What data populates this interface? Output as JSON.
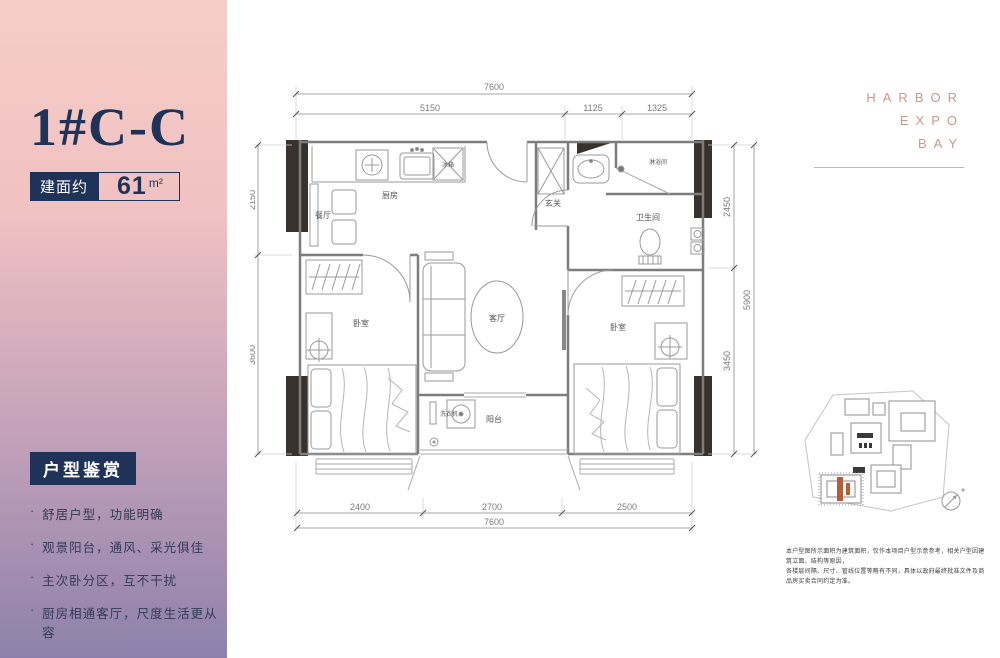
{
  "sidebar": {
    "title": "1#C-C",
    "area_label": "建面约",
    "area_value": "61",
    "area_unit": "m²",
    "section_title": "户型鉴赏",
    "features": [
      "舒居户型，功能明确",
      "观景阳台，通风、采光俱佳",
      "主次卧分区，互不干扰",
      "厨房相通客厅，尺度生活更从容"
    ]
  },
  "brand": {
    "line1": "HARBOR",
    "line2": "EXPO",
    "line3": "BAY"
  },
  "plan": {
    "rooms": {
      "dining": "餐厅",
      "kitchen": "厨房",
      "entry": "玄关",
      "shower": "淋浴间",
      "bathroom": "卫生间",
      "living": "客厅",
      "bedroom_left": "卧室",
      "bedroom_right": "卧室",
      "balcony": "阳台",
      "washer": "洗衣机",
      "fridge": "冰箱"
    },
    "dims": {
      "top_total": "7600",
      "top_segments": [
        "5150",
        "1125",
        "1325"
      ],
      "bottom_segments": [
        "2400",
        "2700",
        "2500"
      ],
      "bottom_total": "7600",
      "left_segments": [
        "2150",
        "3600"
      ],
      "right_segments": [
        "2450",
        "3450"
      ],
      "right_total": "5900"
    }
  },
  "disclaimer": {
    "line1": "本户型图所示面积为建筑面积，仅作本项目户型示意参考，相关户型因建筑立面、结构等原因，",
    "line2": "各楼层间隔、尺寸、管线位置等略有不同，具体以政府最终批准文件及商品房买卖合同约定为准。"
  },
  "colors": {
    "navy": "#1f3258",
    "rose_brand": "#c49a91",
    "gradient_top": "#f6cdc7",
    "gradient_bottom": "#8d81ab",
    "site_highlight": "#b85c38",
    "wall_fill": "#39312b"
  }
}
